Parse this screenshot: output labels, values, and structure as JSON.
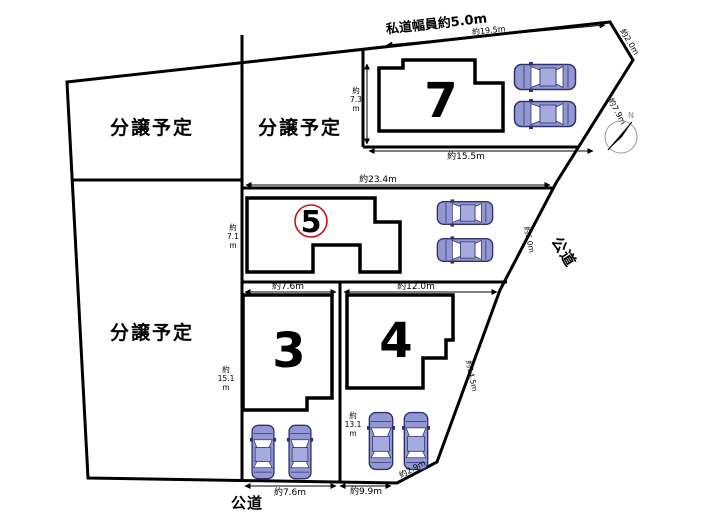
{
  "figure": {
    "type": "land-plot-map",
    "background": "#ffffff"
  },
  "colors": {
    "line": "#000000",
    "car_body": "#9298d4",
    "car_roof": "#a6abdf",
    "car_window": "#ffffff",
    "car_outline": "#30306a",
    "circle_accent": "#cc1111",
    "compass_ring": "#9a9a9a"
  },
  "roads": {
    "top": "私道幅員約5.0m",
    "right": "公道",
    "bottom": "公道"
  },
  "parcels": {
    "sale_top_left": "分譲予定",
    "sale_top_mid": "分譲予定",
    "sale_mid_left": "分譲予定",
    "lot7": "7",
    "lot5": "5",
    "lot3": "3",
    "lot4": "4"
  },
  "compass": {
    "north": "N"
  },
  "measurements": {
    "road_top": "約19.5m",
    "edge_ne": "約2.0m",
    "edge_e1": "約7.9m",
    "edge_e2": "約6.0m",
    "edge_e3": "約14.5m",
    "edge_se": "約2.9m",
    "lot7_width": "約15.5m",
    "lot7_depth": [
      "約",
      "7.3",
      "m"
    ],
    "strip_width": "約23.4m",
    "lot5_depth": [
      "約",
      "7.1",
      "m"
    ],
    "lot3_width": "約7.6m",
    "lot4_width": "約12.0m",
    "lot3_depth": [
      "約",
      "15.1",
      "m"
    ],
    "lot4_depth": [
      "約",
      "13.1",
      "m"
    ],
    "bottom_w1": "約7.6m",
    "bottom_w2": "約9.9m"
  }
}
